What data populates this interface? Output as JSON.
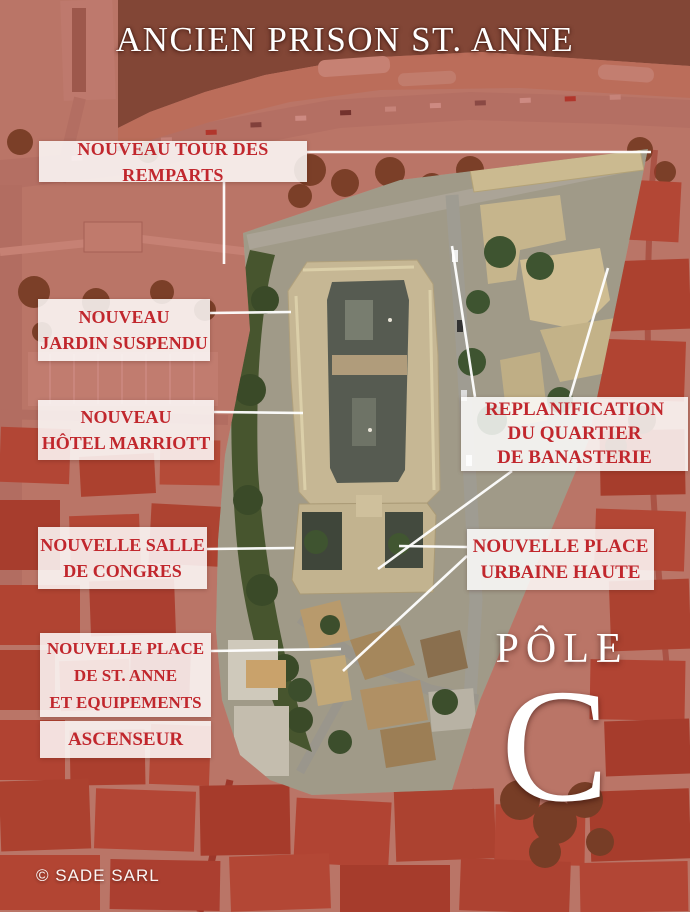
{
  "title": "ANCIEN PRISON ST. ANNE",
  "credit": "© SADE SARL",
  "pole": {
    "word": "PÔLE",
    "letter": "C"
  },
  "labels": [
    {
      "id": "tour-des-remparts",
      "lines": [
        "NOUVEAU TOUR DES REMPARTS"
      ]
    },
    {
      "id": "jardin-suspendu",
      "lines": [
        "NOUVEAU",
        "JARDIN SUSPENDU"
      ]
    },
    {
      "id": "hotel-marriott",
      "lines": [
        "NOUVEAU",
        "HÔTEL MARRIOTT"
      ]
    },
    {
      "id": "salle-de-congres",
      "lines": [
        "NOUVELLE SALLE",
        "DE CONGRES"
      ]
    },
    {
      "id": "place-st-anne",
      "lines": [
        "NOUVELLE PLACE",
        "DE ST. ANNE",
        "ET EQUIPEMENTS"
      ]
    },
    {
      "id": "ascenseur",
      "lines": [
        "ASCENSEUR"
      ]
    },
    {
      "id": "replanification",
      "lines": [
        "REPLANIFICATION",
        "DU QUARTIER",
        "DE BANASTERIE"
      ]
    },
    {
      "id": "place-urbaine",
      "lines": [
        "NOUVELLE PLACE",
        "URBAINE HAUTE"
      ]
    }
  ],
  "colors": {
    "label-text": "#c1272d",
    "label-bg": "rgba(255,255,255,0.84)",
    "overlay-red": "#b22a20",
    "leader-line": "#ffffff"
  }
}
